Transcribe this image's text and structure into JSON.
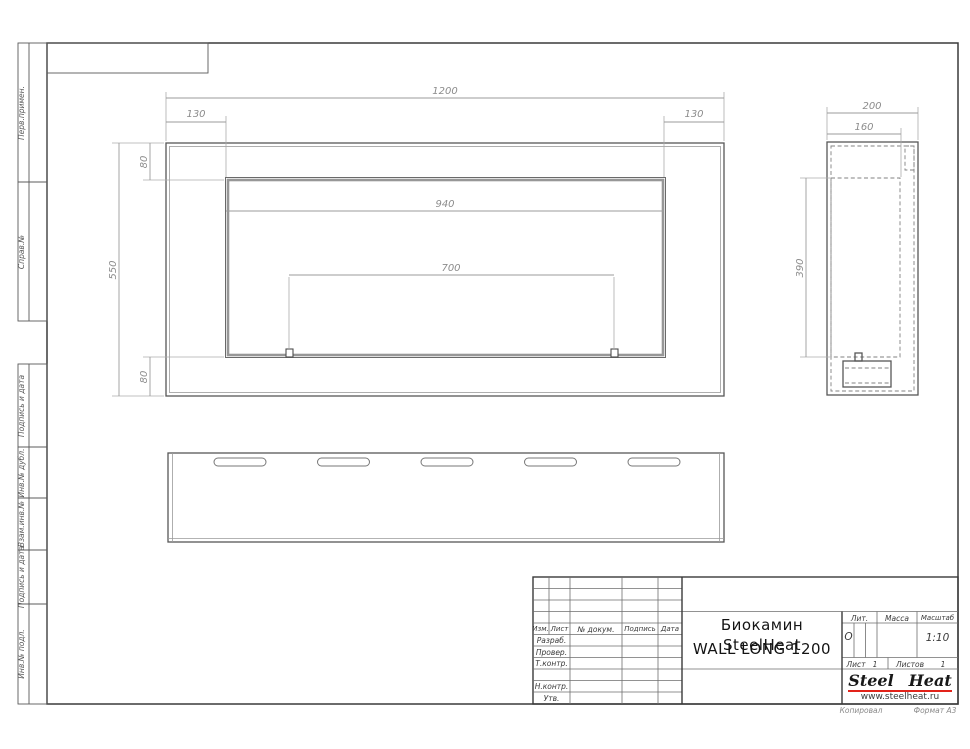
{
  "colors": {
    "accent_red": "#e2231a",
    "line": "#555555",
    "dim_text": "#8c8c8c"
  },
  "margin_labels": [
    "Перв.примен.",
    "Справ.№",
    "Подпись и дата",
    "Инв.№ дубл.",
    "Взам.инв.№",
    "Подпись и дата",
    "Инв.№ подл."
  ],
  "front_view": {
    "dim_width": "1200",
    "dim_left": "130",
    "dim_right": "130",
    "dim_opening": "940",
    "dim_burner": "700",
    "dim_height": "550",
    "dim_top": "80",
    "dim_bottom": "80"
  },
  "side_view": {
    "dim_depth": "200",
    "dim_inner": "160",
    "dim_height": "390"
  },
  "title_block": {
    "col_izm": "Изм.",
    "col_list": "Лист",
    "col_dokum": "№ докум.",
    "col_podpis": "Подпись",
    "col_data": "Дата",
    "row_razrab": "Разраб.",
    "row_prover": "Провер.",
    "row_tkontr": "Т.контр.",
    "row_nkontr": "Н.контр.",
    "row_utv": "Утв.",
    "title_line1": "Биокамин SteelHeat",
    "title_line2": "WALL LONG 1200",
    "lit_label": "Лит.",
    "lit_value": "О",
    "massa_label": "Масса",
    "masshtab_label": "Масштаб",
    "masshtab_value": "1:10",
    "list_label": "Лист",
    "list_value": "1",
    "listov_label": "Листов",
    "listov_value": "1"
  },
  "logo": {
    "steel": "Steel",
    "heat": "Heat",
    "url": "www.steelheat.ru"
  },
  "footer": {
    "kopiroval": "Копировал",
    "format": "Формат  А3"
  }
}
